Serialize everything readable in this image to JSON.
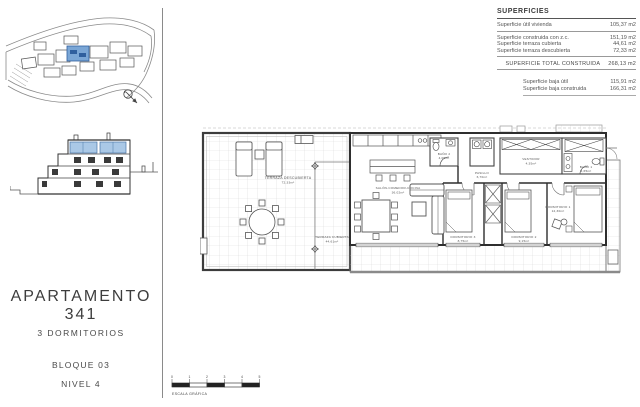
{
  "title_block": {
    "apartment": "APARTAMENTO 341",
    "subtitle": "3 DORMITORIOS",
    "block": "BLOQUE 03",
    "level": "NIVEL 4"
  },
  "superficies": {
    "header": "SUPERFICIES",
    "rows": [
      {
        "label": "Superficie útil vivienda",
        "value": "105,37 m2"
      },
      {
        "label": "Superficie construida con z.c.",
        "value": "151,19 m2"
      },
      {
        "label": "Superficie terraza cubierta",
        "value": "44,61 m2"
      },
      {
        "label": "Superficie terraza descubierta",
        "value": "72,33 m2"
      }
    ],
    "total": {
      "label": "SUPERFICIE TOTAL CONSTRUIDA",
      "value": "268,13 m2"
    },
    "extra_rows": [
      {
        "label": "Superficie baja útil",
        "value": "115,91 m2"
      },
      {
        "label": "Superficie baja construida",
        "value": "166,31 m2"
      }
    ]
  },
  "plan": {
    "rooms": {
      "terraza_descubierta": {
        "name": "TERRAZA DESCUBIERTA",
        "area": "72,33m²"
      },
      "terraza_cubierta": {
        "name": "TERRAZA CUBIERTA",
        "area": "44,61m²"
      },
      "salon": {
        "name": "SALÓN-COMEDOR-COCINA",
        "area": "36,02m²"
      },
      "pasillo": {
        "name": "PASILLO",
        "area": "6,70m²"
      },
      "bano2": {
        "name": "BAÑO 2",
        "area": "4,05m²"
      },
      "vestidor": {
        "name": "VESTIDOR",
        "area": "4,35m²"
      },
      "bano1": {
        "name": "BAÑO 1",
        "area": "4,65m²"
      },
      "dorm3": {
        "name": "DORMITORIO 3",
        "area": "8,75m²"
      },
      "dorm2": {
        "name": "DORMITORIO 2",
        "area": "9,15m²"
      },
      "dorm1": {
        "name": "DORMITORIO 1",
        "area": "12,30m²"
      }
    }
  },
  "scale_bar": {
    "label": "ESCALA GRÁFICA",
    "units": [
      "0",
      "1",
      "2",
      "3",
      "4",
      "5"
    ]
  },
  "icons": {
    "north_arrow": "north-arrow-icon"
  },
  "colors": {
    "highlight_blue": "#7aa6d6",
    "highlight_blue_dark": "#2f5f9e",
    "section_glass_blue": "#aac8e6",
    "line": "#3c3c3c",
    "tile_grid": "#d9d9d9",
    "heavy_gray": "#8a8a8a"
  }
}
